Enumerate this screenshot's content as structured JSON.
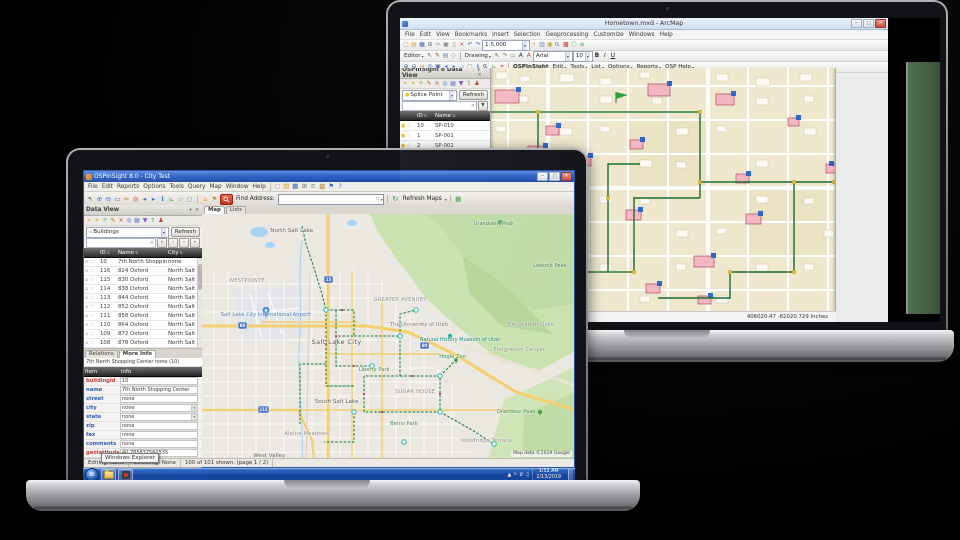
{
  "scene": {
    "background": "#000000"
  },
  "back_laptop": {
    "window_title": "Hometown.mxd - ArcMap",
    "window_buttons": {
      "minimize": "─",
      "maximize": "□",
      "close": "✕"
    },
    "menu_items": [
      "File",
      "Edit",
      "View",
      "Bookmarks",
      "Insert",
      "Selection",
      "Geoprocessing",
      "Customize",
      "Windows",
      "Help"
    ],
    "scale_value": "1:5,000",
    "standard_toolbar_icons": [
      {
        "n": "new-map-icon",
        "g": "▢",
        "c": "#c8a430"
      },
      {
        "n": "open-icon",
        "g": "▤",
        "c": "#d9a23c"
      },
      {
        "n": "save-icon",
        "g": "▦",
        "c": "#3a66b0"
      },
      {
        "n": "print-icon",
        "g": "⊞",
        "c": "#7a7a7a"
      },
      {
        "n": "cut-icon",
        "g": "✂",
        "c": "#7a7a7a"
      },
      {
        "n": "copy-icon",
        "g": "▣",
        "c": "#7a7a7a"
      },
      {
        "n": "paste-icon",
        "g": "▯",
        "c": "#b58a3a"
      },
      {
        "n": "delete-icon",
        "g": "×",
        "c": "#c0392b"
      },
      {
        "n": "undo-icon",
        "g": "↶",
        "c": "#3a66b0"
      },
      {
        "n": "redo-icon",
        "g": "↷",
        "c": "#3a66b0"
      }
    ],
    "post_scale_icons": [
      {
        "n": "add-data-icon",
        "g": "＋",
        "c": "#caa02c"
      },
      {
        "n": "toc-icon",
        "g": "▥",
        "c": "#5b84c4"
      },
      {
        "n": "catalog-icon",
        "g": "▣",
        "c": "#caa02c"
      },
      {
        "n": "search-icon",
        "g": "⚲",
        "c": "#3a66b0"
      },
      {
        "n": "arctoolbox-icon",
        "g": "▩",
        "c": "#c0392b"
      },
      {
        "n": "model-builder-icon",
        "g": "⬡",
        "c": "#4a9e46"
      },
      {
        "n": "python-icon",
        "g": "≡",
        "c": "#4a9e46"
      }
    ],
    "editor_toolbar": {
      "editor_label": "Editor",
      "drawing_label": "Drawing",
      "font_name": "Arial",
      "font_size": "10",
      "bold": "B",
      "italic": "I",
      "underline": "U"
    },
    "editor_icons": [
      {
        "n": "edit-tool-icon",
        "g": "↖",
        "c": "#444444"
      },
      {
        "n": "create-features-icon",
        "g": "✎",
        "c": "#7a5230"
      },
      {
        "n": "attributes-icon",
        "g": "▤",
        "c": "#5b84c4"
      },
      {
        "n": "snapping-icon",
        "g": "◇",
        "c": "#777777"
      }
    ],
    "drawing_icons": [
      {
        "n": "select-elements-icon",
        "g": "↖",
        "c": "#444444"
      },
      {
        "n": "rotate-icon",
        "g": "↷",
        "c": "#777777"
      },
      {
        "n": "rectangle-icon",
        "g": "▭",
        "c": "#4a9e46"
      },
      {
        "n": "text-icon",
        "g": "A",
        "c": "#222222"
      },
      {
        "n": "font-color-icon",
        "g": "A",
        "c": "#c0392b"
      }
    ],
    "tools_toolbar_icons": [
      {
        "n": "zoom-in-icon",
        "g": "⊕",
        "c": "#3a66b0"
      },
      {
        "n": "zoom-out-icon",
        "g": "⊖",
        "c": "#3a66b0"
      },
      {
        "n": "pan-icon",
        "g": "↔",
        "c": "#c78a2e"
      },
      {
        "n": "full-extent-icon",
        "g": "◎",
        "c": "#3a66b0"
      },
      {
        "n": "fixed-zoom-in-icon",
        "g": "▣",
        "c": "#3a66b0"
      },
      {
        "n": "back-extent-icon",
        "g": "◂",
        "c": "#2a6fd0"
      },
      {
        "n": "forward-extent-icon",
        "g": "▸",
        "c": "#2a6fd0"
      },
      {
        "n": "select-features-icon",
        "g": "▱",
        "c": "#58b0e0"
      },
      {
        "n": "clear-selection-icon",
        "g": "▢",
        "c": "#888888"
      },
      {
        "n": "identify-icon",
        "g": "ℹ",
        "c": "#2a6fd0"
      },
      {
        "n": "find-icon",
        "g": "⚲",
        "c": "#333333"
      },
      {
        "n": "measure-icon",
        "g": "⊾",
        "c": "#4a9e46"
      },
      {
        "n": "go-to-xy-icon",
        "g": "⌖",
        "c": "#c0392b"
      }
    ],
    "osp_menu": {
      "brand": "OSPInSight",
      "items": [
        "Edit",
        "Tools",
        "List",
        "Options",
        "Reports",
        "OSP Help"
      ]
    },
    "data_view": {
      "title": "OSPInSight 8 Data View",
      "panel_icons": [
        {
          "n": "zoom-to-icon",
          "g": "⌖",
          "c": "#d98f2b"
        },
        {
          "n": "flash-icon",
          "g": "✦",
          "c": "#d9b02b"
        },
        {
          "n": "add-record-icon",
          "g": "＋",
          "c": "#3f9e3f"
        },
        {
          "n": "edit-record-icon",
          "g": "✎",
          "c": "#b5651d"
        },
        {
          "n": "delete-record-icon",
          "g": "×",
          "c": "#c0392b"
        },
        {
          "n": "locate-icon",
          "g": "◎",
          "c": "#2a6fd0"
        },
        {
          "n": "table-icon",
          "g": "▦",
          "c": "#5b84c4"
        },
        {
          "n": "filter-icon",
          "g": "▼",
          "c": "#7a4fd0"
        },
        {
          "n": "export-icon",
          "g": "⇪",
          "c": "#3f9e3f"
        },
        {
          "n": "user-icon",
          "g": "♟",
          "c": "#c0392b"
        }
      ],
      "layer_combo": "Splice Point",
      "refresh_label": "Refresh",
      "columns": [
        "ID",
        "Name"
      ],
      "rows": [
        [
          "10",
          "SP-010"
        ],
        [
          "1",
          "SP-001"
        ],
        [
          "2",
          "SP-002"
        ],
        [
          "3",
          "SP-003"
        ],
        [
          "4",
          "SP-004"
        ],
        [
          "5",
          "SP-005"
        ],
        [
          "6",
          "SP-006"
        ],
        [
          "7",
          "SP-007"
        ]
      ]
    },
    "create_features": {
      "title": "Create Features",
      "search_placeholder": "<Search>",
      "groups": [
        {
          "header": "Access Point",
          "items": [
            {
              "label": "Access Point",
              "icon": "access-point-icon",
              "color": "#9aa0a6",
              "shape": "square"
            }
          ]
        },
        {
          "header": "Building",
          "items": [
            {
              "label": "Building",
              "icon": "building-icon",
              "color": "#f2b6c4",
              "shape": "square"
            }
          ]
        },
        {
          "header": "Cable Span",
          "items": [
            {
              "label": "ISP 2",
              "icon": "isp-cable-icon",
              "color": "#2f8f3a",
              "shape": "line"
            },
            {
              "label": "Cable Span",
              "icon": "cable-span-icon",
              "color": "#6fbf4a",
              "shape": "line"
            }
          ]
        },
        {
          "header": "Duct Bank",
          "items": [
            {
              "label": "Duct Bank",
              "icon": "duct-bank-icon",
              "color": "#555555",
              "shape": "line"
            }
          ]
        },
        {
          "header": "Pole",
          "items": [
            {
              "label": "Pole",
              "icon": "pole-icon",
              "color": "#8a5a2a",
              "shape": "dot"
            }
          ]
        },
        {
          "header": "Slack Point",
          "items": [
            {
              "label": "Slack Point",
              "icon": "slack-point-icon",
              "color": "#d8a72c",
              "shape": "dot"
            }
          ]
        },
        {
          "header": "Splice Point",
          "items": [
            {
              "label": "Splice Point",
              "icon": "splice-point-icon",
              "color": "#e8c22a",
              "shape": "dot"
            }
          ]
        },
        {
          "header": "Termination Point",
          "items": [
            {
              "label": "Termination Point",
              "icon": "termination-point-icon",
              "color": "#2f66c9",
              "shape": "square"
            }
          ]
        }
      ],
      "construction_title": "Construction Tools",
      "construction_hint": "Select a template."
    },
    "status_text": "406020.47 -82020.729 Inches",
    "map_colors": {
      "land": "#efe8cf",
      "building_highlight": "#f3b7c3",
      "network": "#1b6e2e",
      "node": "#f4c430"
    }
  },
  "front_laptop": {
    "window_title": "OSPInSight 8.0 - City Test",
    "window_buttons": {
      "minimize": "─",
      "maximize": "□",
      "close": "✕"
    },
    "menu_items": [
      "File",
      "Edit",
      "Reports",
      "Options",
      "Tools",
      "Query",
      "Map",
      "Window",
      "Help"
    ],
    "menu_icons": [
      {
        "n": "new-icon",
        "g": "▢",
        "c": "#caa02c"
      },
      {
        "n": "open-icon",
        "g": "▤",
        "c": "#caa02c"
      },
      {
        "n": "save-icon",
        "g": "▦",
        "c": "#3a66b0"
      },
      {
        "n": "print-icon",
        "g": "⊞",
        "c": "#777777"
      },
      {
        "n": "layers-icon",
        "g": "≡",
        "c": "#4a9e46"
      },
      {
        "n": "legend-icon",
        "g": "▥",
        "c": "#b5651d"
      },
      {
        "n": "bookmark-icon",
        "g": "⚑",
        "c": "#2a6fd0"
      },
      {
        "n": "help-icon",
        "g": "?",
        "c": "#2a6fd0"
      }
    ],
    "toolbar_icons": [
      {
        "n": "select-arrow-icon",
        "g": "↖",
        "c": "#333333"
      },
      {
        "n": "zoom-in-icon",
        "g": "⊕",
        "c": "#2a6fd0"
      },
      {
        "n": "zoom-out-icon",
        "g": "⊖",
        "c": "#2a6fd0"
      },
      {
        "n": "zoom-box-icon",
        "g": "▭",
        "c": "#2a6fd0"
      },
      {
        "n": "pan-icon",
        "g": "↔",
        "c": "#c78a2e"
      },
      {
        "n": "full-extent-icon",
        "g": "◎",
        "c": "#c0392b"
      },
      {
        "n": "previous-extent-icon",
        "g": "◂",
        "c": "#2a6fd0"
      },
      {
        "n": "next-extent-icon",
        "g": "▸",
        "c": "#2a6fd0"
      },
      {
        "n": "identify-icon",
        "g": "ℹ",
        "c": "#2a6fd0"
      },
      {
        "n": "measure-icon",
        "g": "⊾",
        "c": "#4a9e46"
      },
      {
        "n": "select-features-icon",
        "g": "▱",
        "c": "#58b0e0"
      },
      {
        "n": "clear-selection-icon",
        "g": "▢",
        "c": "#888888"
      }
    ],
    "address_icons": [
      {
        "n": "locate-building-icon",
        "g": "⌂",
        "c": "#d98f2b"
      },
      {
        "n": "locate-flag-icon",
        "g": "⚑",
        "c": "#d98f2b"
      }
    ],
    "find_address": {
      "label": "Find Address:",
      "value": ""
    },
    "refresh_maps_label": "Refresh Maps",
    "data_view": {
      "title": "Data View",
      "panel_icons": [
        {
          "n": "zoom-to-icon",
          "g": "⌖",
          "c": "#d98f2b"
        },
        {
          "n": "flash-icon",
          "g": "✦",
          "c": "#d9b02b"
        },
        {
          "n": "add-record-icon",
          "g": "＋",
          "c": "#3f9e3f"
        },
        {
          "n": "edit-record-icon",
          "g": "✎",
          "c": "#b5651d"
        },
        {
          "n": "delete-record-icon",
          "g": "×",
          "c": "#c0392b"
        },
        {
          "n": "locate-icon",
          "g": "◎",
          "c": "#2a6fd0"
        },
        {
          "n": "table-icon",
          "g": "▦",
          "c": "#5b84c4"
        },
        {
          "n": "filter-icon",
          "g": "▼",
          "c": "#7a4fd0"
        },
        {
          "n": "export-icon",
          "g": "⇪",
          "c": "#3f9e3f"
        },
        {
          "n": "user-icon",
          "g": "♟",
          "c": "#c0392b"
        }
      ],
      "layer_combo": "Buildings",
      "refresh_label": "Refresh",
      "columns": [
        "ID",
        "Name",
        "City"
      ],
      "rows": [
        [
          "10",
          "7th North Shopping",
          "none"
        ],
        [
          "116",
          "824 Oxford",
          "North Salt Lake"
        ],
        [
          "115",
          "830 Oxford",
          "North Salt Lake"
        ],
        [
          "114",
          "838 Oxford",
          "North Salt Lake"
        ],
        [
          "113",
          "844 Oxford",
          "North Salt Lake"
        ],
        [
          "112",
          "852 Oxford",
          "North Salt Lake"
        ],
        [
          "111",
          "858 Oxford",
          "North Salt Lake"
        ],
        [
          "110",
          "864 Oxford",
          "North Salt Lake"
        ],
        [
          "109",
          "872 Oxford",
          "North Salt Lake"
        ],
        [
          "108",
          "878 Oxford",
          "North Salt Lake"
        ]
      ]
    },
    "info_panel": {
      "tabs": [
        "Relations",
        "More Info"
      ],
      "active_tab": "More Info",
      "header": "7th North Shopping Center none (10)",
      "columns": [
        "Item",
        "Info"
      ],
      "fields": [
        {
          "label": "buildingid",
          "value": "10",
          "label_color": "red"
        },
        {
          "label": "name",
          "value": "7th North Shopping Center",
          "label_color": "blue"
        },
        {
          "label": "street",
          "value": "none",
          "label_color": "blue"
        },
        {
          "label": "city",
          "value": "none",
          "label_color": "blue",
          "dropdown": true
        },
        {
          "label": "state",
          "value": "none",
          "label_color": "blue",
          "dropdown": true
        },
        {
          "label": "zip",
          "value": "none",
          "label_color": "blue"
        },
        {
          "label": "fax",
          "value": "none",
          "label_color": "blue"
        },
        {
          "label": "comments",
          "value": "none",
          "label_color": "blue"
        },
        {
          "label": "geolatitude",
          "value": "40.785837560535",
          "label_color": "red"
        },
        {
          "label": "geolongitude",
          "value": "-111.940978806352",
          "label_color": "red"
        }
      ]
    },
    "bottom_tabs": [
      "Data View",
      "Templates and Defaults"
    ],
    "map_tabs": [
      "Map",
      "Lists"
    ],
    "active_map_tab": "Map",
    "map": {
      "attribution": "Map data ©2019 Google",
      "labels": [
        {
          "t": "North Salt Lake",
          "x": 24,
          "y": 7,
          "k": "city"
        },
        {
          "t": "Grandview Peak",
          "x": 78,
          "y": 4,
          "k": "peak"
        },
        {
          "t": "Lookout Peak",
          "x": 93,
          "y": 21,
          "k": "peak"
        },
        {
          "t": "WESTPOINTE",
          "x": 12,
          "y": 27,
          "k": "area"
        },
        {
          "t": "Salt Lake City International Airport",
          "x": 17,
          "y": 41,
          "k": "poi-blue"
        },
        {
          "t": "GREATER AVENUES",
          "x": 53,
          "y": 35,
          "k": "area"
        },
        {
          "t": "The University of Utah",
          "x": 58,
          "y": 45,
          "k": "area2"
        },
        {
          "t": "Natural History Museum of Utah",
          "x": 69,
          "y": 51,
          "k": "poi-teal"
        },
        {
          "t": "Emigration Oaks",
          "x": 88,
          "y": 45,
          "k": "area"
        },
        {
          "t": "Emigration Canyon",
          "x": 85,
          "y": 55,
          "k": "area"
        },
        {
          "t": "Salt Lake City",
          "x": 36,
          "y": 52,
          "k": "city-big"
        },
        {
          "t": "Hogle Zoo",
          "x": 67,
          "y": 58,
          "k": "poi-green"
        },
        {
          "t": "Liberty Park",
          "x": 46,
          "y": 63,
          "k": "park"
        },
        {
          "t": "SUGAR HOUSE",
          "x": 57,
          "y": 72,
          "k": "area"
        },
        {
          "t": "South Salt Lake",
          "x": 36,
          "y": 76,
          "k": "city"
        },
        {
          "t": "Berns Park",
          "x": 54,
          "y": 85,
          "k": "park"
        },
        {
          "t": "Grandeur Peak",
          "x": 84,
          "y": 80,
          "k": "poi-green"
        },
        {
          "t": "Woodridge Terrace",
          "x": 76,
          "y": 92,
          "k": "area"
        },
        {
          "t": "Alpine Meadows",
          "x": 28,
          "y": 89,
          "k": "area"
        },
        {
          "t": "West Valley",
          "x": 18,
          "y": 98,
          "k": "city"
        }
      ]
    },
    "status_segments": [
      "Editing: None",
      "Selecting: None",
      "100 of 101 shown.  (page 1 / 2)"
    ],
    "tooltip": "Windows Explorer",
    "taskbar": {
      "time": "1:52 AM",
      "date": "2/13/2019",
      "tray_icons": [
        {
          "n": "show-hidden-icons-icon",
          "g": "▲"
        },
        {
          "n": "action-center-icon",
          "g": "⚐"
        },
        {
          "n": "network-icon",
          "g": "⇵"
        },
        {
          "n": "volume-icon",
          "g": "♫"
        }
      ]
    }
  }
}
